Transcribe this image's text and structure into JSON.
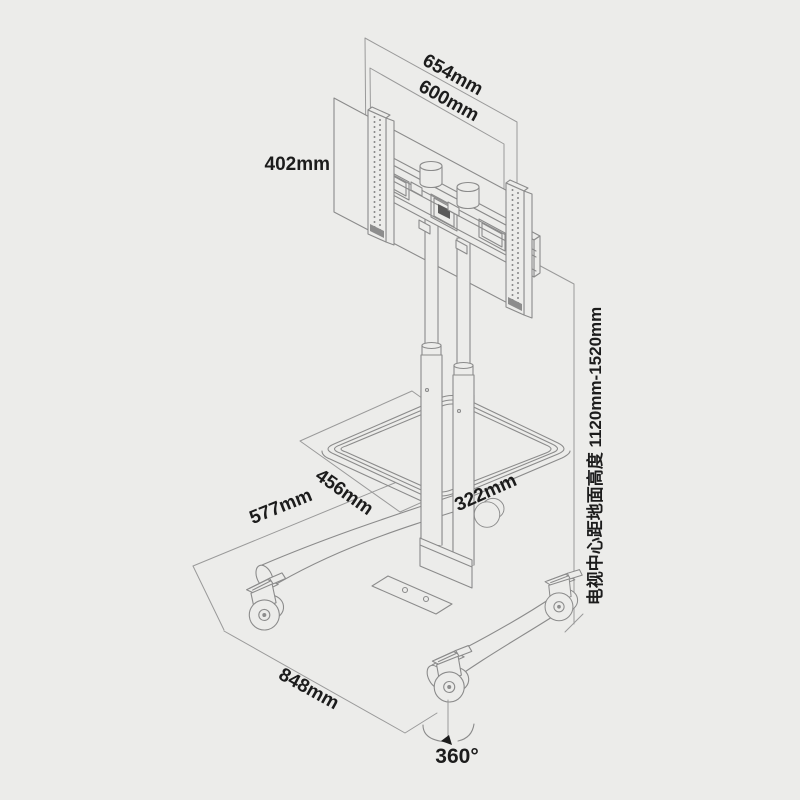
{
  "page": {
    "description": "Mobile TV cart stand dimension drawing",
    "background_color": "#ececea",
    "line_color": "#8b8b8b",
    "dim_line_color": "#9a9a9a",
    "text_color": "#1c1c1c"
  },
  "dimensions": {
    "bracket_width": "654mm",
    "vesa_width": "600mm",
    "vesa_height": "402mm",
    "shelf_depth": "456mm",
    "base_depth": "577mm",
    "shelf_width": "322mm",
    "base_width": "848mm",
    "caster_swivel": "360°",
    "tv_center_height": "电视中心距地面高度 1120mm-1520mm"
  }
}
